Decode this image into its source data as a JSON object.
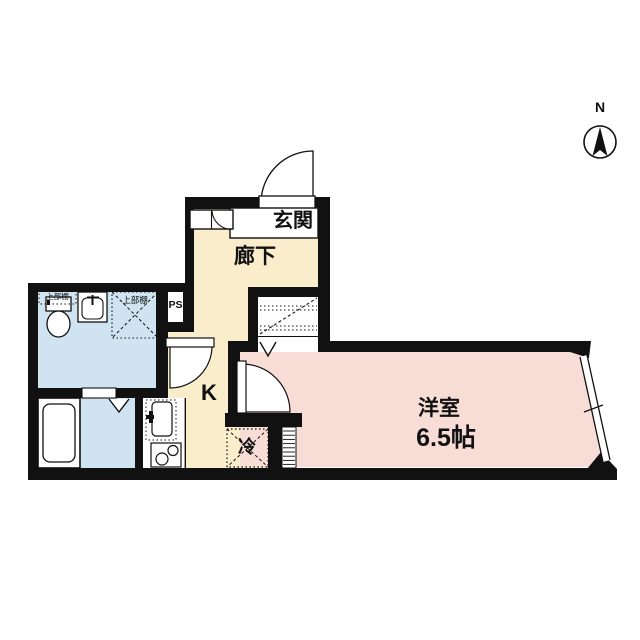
{
  "compass": {
    "label": "N"
  },
  "labels": {
    "entrance": "玄関",
    "hallway": "廊下",
    "kitchen": "K",
    "refrigerator": "冷",
    "western_room": "洋室",
    "western_room_size": "6.5帖",
    "pipe_space": "PS",
    "upper_shelf": "上部棚"
  },
  "colors": {
    "wall": "#111111",
    "hallway_floor": "#f9edcb",
    "western_room_floor": "#f8ddd6",
    "wet_area_floor": "#cfe4f0",
    "fixture_white": "#ffffff",
    "line": "#111111"
  }
}
